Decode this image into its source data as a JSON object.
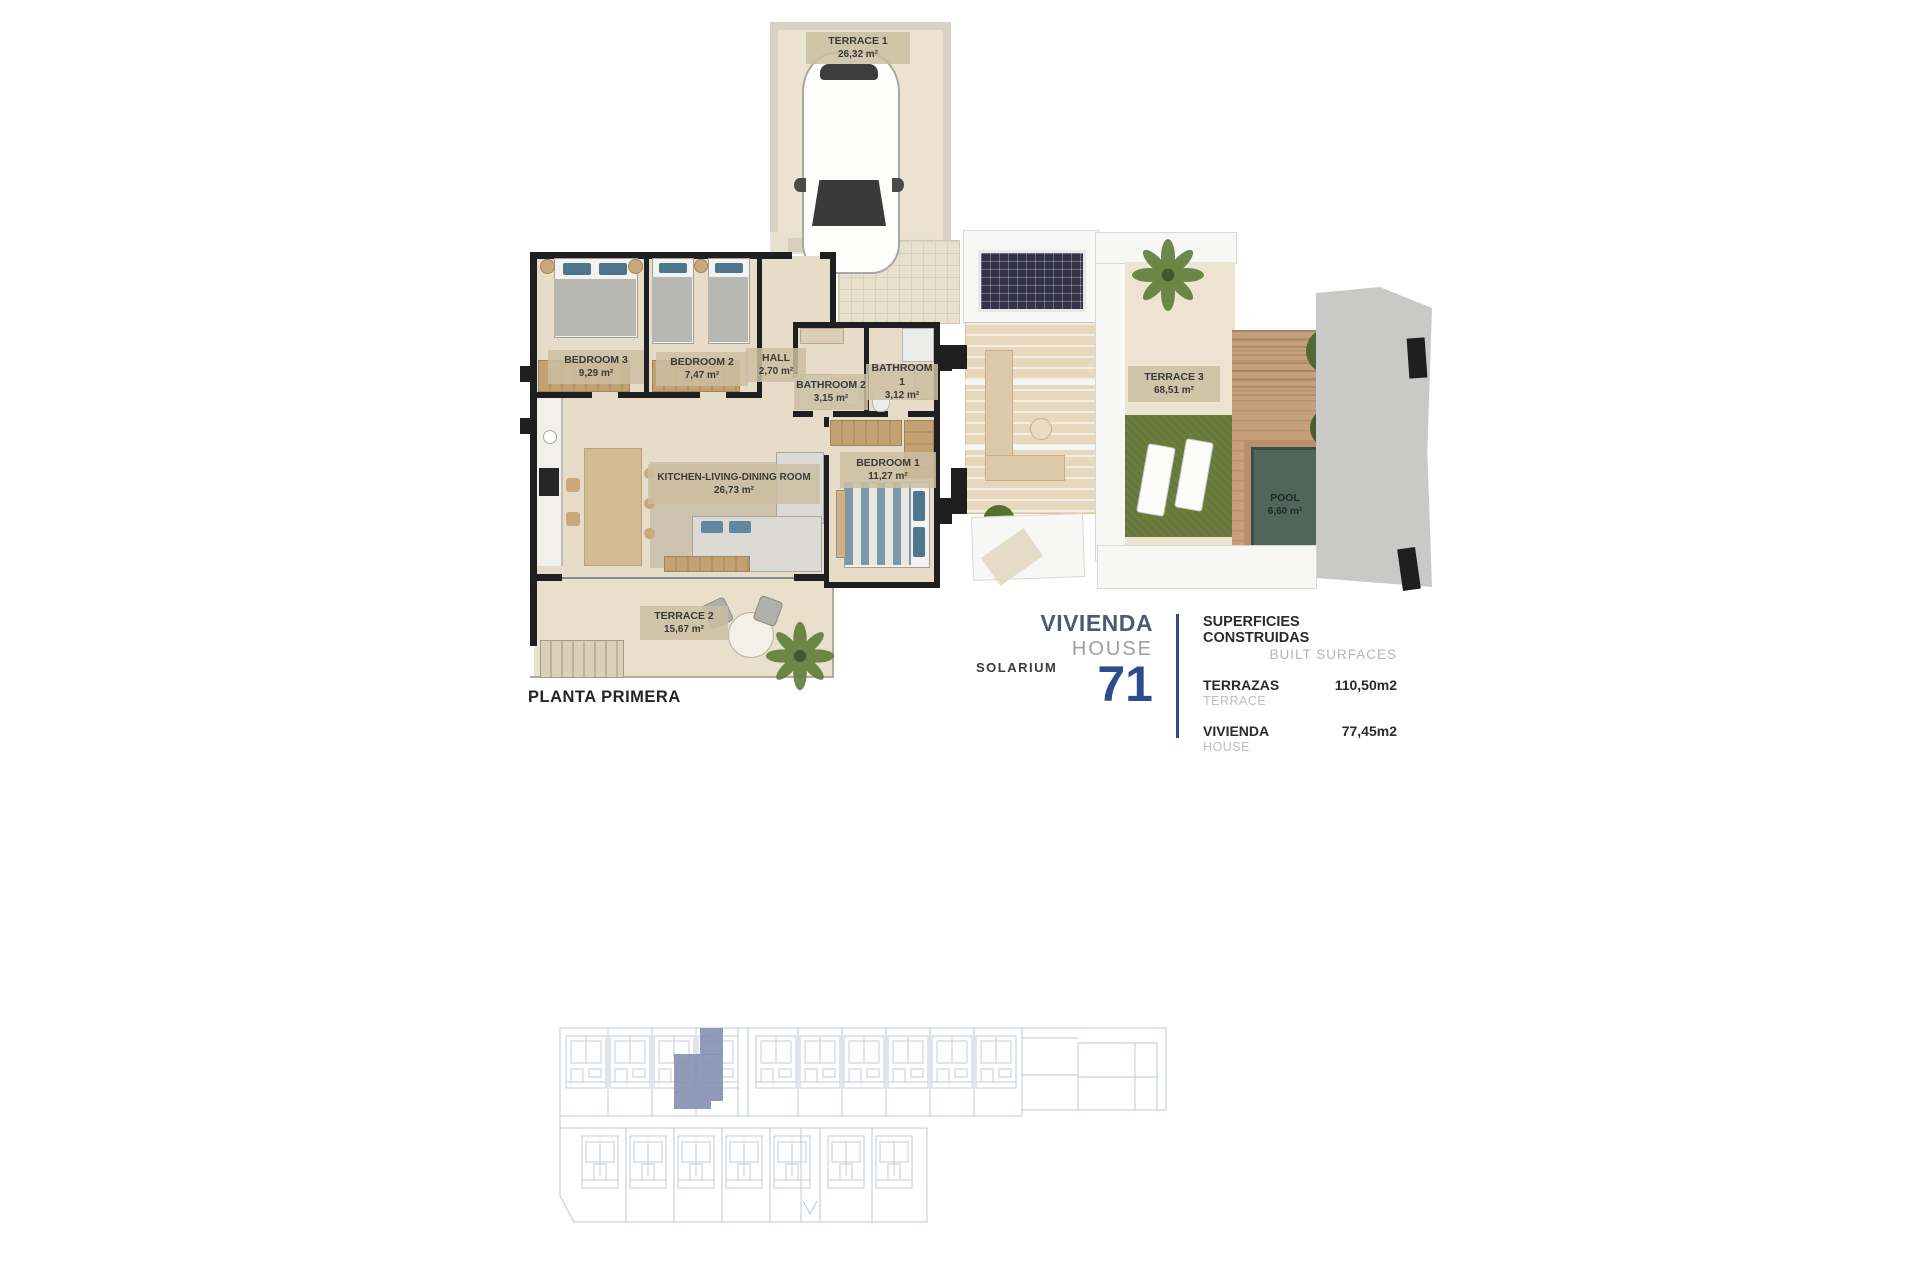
{
  "floor_plan": {
    "title": "PLANTA PRIMERA",
    "rooms": {
      "terrace1": {
        "label": "TERRACE 1",
        "area": "26,32 m²"
      },
      "bedroom3": {
        "label": "BEDROOM 3",
        "area": "9,29 m²"
      },
      "bedroom2": {
        "label": "BEDROOM 2",
        "area": "7,47 m²"
      },
      "hall": {
        "label": "HALL",
        "area": "2,70 m²"
      },
      "bathroom2": {
        "label": "BATHROOM 2",
        "area": "3,15 m²"
      },
      "bathroom1": {
        "label": "BATHROOM 1",
        "area": "3,12 m²"
      },
      "bedroom1": {
        "label": "BEDROOM 1",
        "area": "11,27 m²"
      },
      "kitchen": {
        "label": "KITCHEN-LIVING-DINING ROOM",
        "area": "26,73 m²"
      },
      "terrace2": {
        "label": "TERRACE 2",
        "area": "15,67 m²"
      }
    }
  },
  "solarium": {
    "title": "SOLARIUM",
    "rooms": {
      "terrace3": {
        "label": "TERRACE 3",
        "area": "68,51 m²"
      },
      "pool": {
        "label": "POOL",
        "area": "6,60 m²"
      }
    }
  },
  "info": {
    "unit_label_es": "VIVIENDA",
    "unit_label_en": "HOUSE",
    "unit_number": "71",
    "surfaces_title_es": "SUPERFICIES CONSTRUIDAS",
    "surfaces_title_en": "BUILT SURFACES",
    "rows": [
      {
        "label_es": "TERRAZAS",
        "label_en": "TERRACE",
        "value": "110,50m2"
      },
      {
        "label_es": "VIVIENDA",
        "label_en": "HOUSE",
        "value": "77,45m2"
      }
    ]
  },
  "colors": {
    "accent_navy": "#2d4b8e",
    "heading_blue_gray": "#4e5a75",
    "site_highlight": "#8791b3",
    "wall_black": "#1f1f1f",
    "floor_beige": "#e6dcc8",
    "grass_green": "#6d7d3f",
    "pool_water": "#50665c",
    "deck_wood": "#c6a07c"
  }
}
